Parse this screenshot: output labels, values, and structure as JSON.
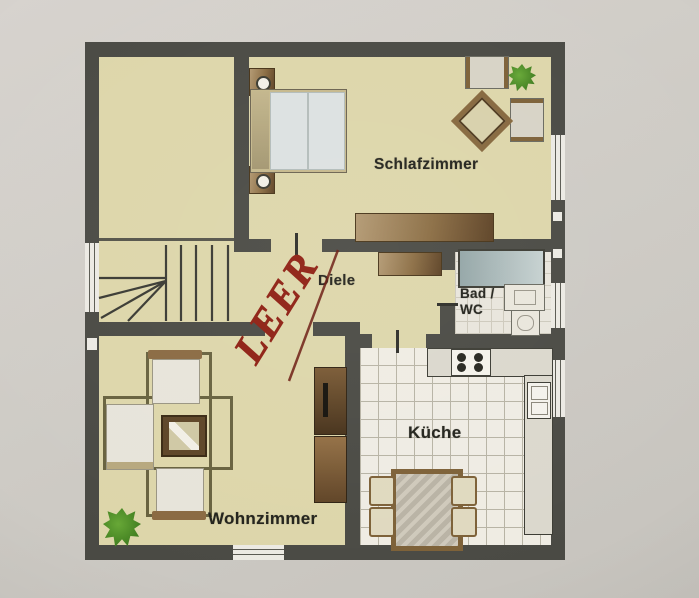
{
  "document": {
    "type": "floor-plan-photo"
  },
  "rooms": {
    "schlafzimmer": {
      "label": "Schlafzimmer"
    },
    "diele": {
      "label": "Diele"
    },
    "bad": {
      "line1": "Bad /",
      "line2": "WC"
    },
    "kueche": {
      "label": "Küche"
    },
    "wohnzimmer": {
      "label": "Wohnzimmer"
    }
  },
  "annotation": {
    "text": "LEER",
    "color": "#8e1f12",
    "style": "handwritten-diagonal"
  },
  "icons": {
    "plant": "star-blob-shape",
    "stove": "four-burner-circles",
    "staircase": "steps-with-fan-lines",
    "window": "double-line-stripe"
  },
  "colors": {
    "wall": "#4a4a44",
    "floor_beige": "#ddd6aa",
    "kitchen_tile": "#efece3",
    "furniture_brown": "#8a6c42",
    "mattress_blue": "#dce1e1",
    "bathtub_blue": "#a9b9b9",
    "plant_green": "#3f7d22",
    "annotation_red": "#8e1f12",
    "background_gray": "#cfccc6"
  }
}
